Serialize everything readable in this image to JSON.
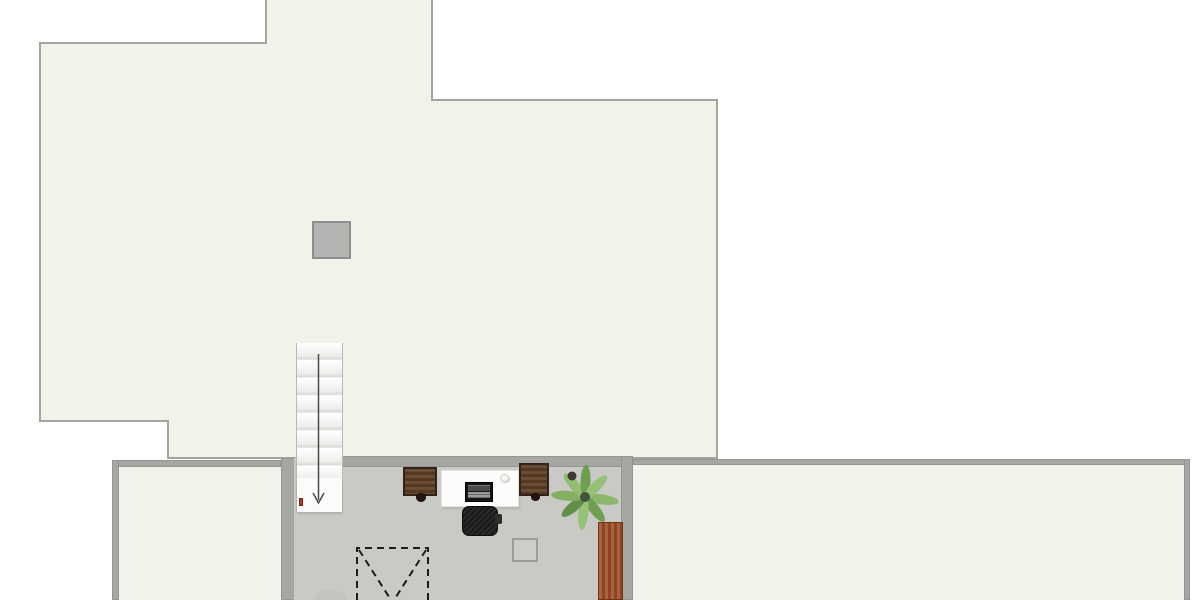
{
  "canvas": {
    "width": 1200,
    "height": 600
  },
  "palette": {
    "background": "#ffffff",
    "floor_cream": "#f2f2ea",
    "outline": "#a3a3a0",
    "wall": "#a6a6a3",
    "wall_edge": "#8f8f8d",
    "floor_gray": "#c9c9c6",
    "chimney": "#b4b4b2",
    "wood_dark": "#5d3e26",
    "wood_edge": "#33221a",
    "wood_red": "#a34f28",
    "wood_red_edge": "#6e3419",
    "chair_black": "#1f1f1f",
    "desk_white": "#fcfcfb",
    "device_black": "#151515",
    "plant_green": "#7fae5e",
    "marker_red": "#b23a2e",
    "dash_black": "#1c1c1c",
    "tread_white": "#fbfbfa"
  },
  "plan": {
    "roof": {
      "name": "roof-deck",
      "fill_key": "floor_cream",
      "outline_key": "outline"
    },
    "chimney": {
      "name": "chimney",
      "fill_key": "chimney"
    },
    "rooms": [
      {
        "name": "room-bottom-left",
        "fill_key": "floor_cream"
      },
      {
        "name": "room-center-gray",
        "fill_key": "floor_gray"
      },
      {
        "name": "room-bottom-right",
        "fill_key": "floor_cream"
      }
    ],
    "stairs": {
      "name": "staircase",
      "direction": "down",
      "tread_count": 8,
      "arrow": "down-arrow"
    },
    "furniture": [
      {
        "name": "cabinet-left",
        "color_key": "wood_dark"
      },
      {
        "name": "desk-white",
        "color_key": "desk_white"
      },
      {
        "name": "laptop",
        "color_key": "device_black"
      },
      {
        "name": "mouse",
        "color_key": "desk_white"
      },
      {
        "name": "cabinet-right",
        "color_key": "wood_dark"
      },
      {
        "name": "office-chair",
        "color_key": "chair_black"
      },
      {
        "name": "palm-plant",
        "color_key": "plant_green"
      },
      {
        "name": "sideboard",
        "color_key": "wood_red"
      },
      {
        "name": "square-stool",
        "color_key": "floor_gray"
      },
      {
        "name": "void-opening",
        "style": "dashed-x"
      },
      {
        "name": "door-marker",
        "color_key": "marker_red"
      }
    ]
  }
}
